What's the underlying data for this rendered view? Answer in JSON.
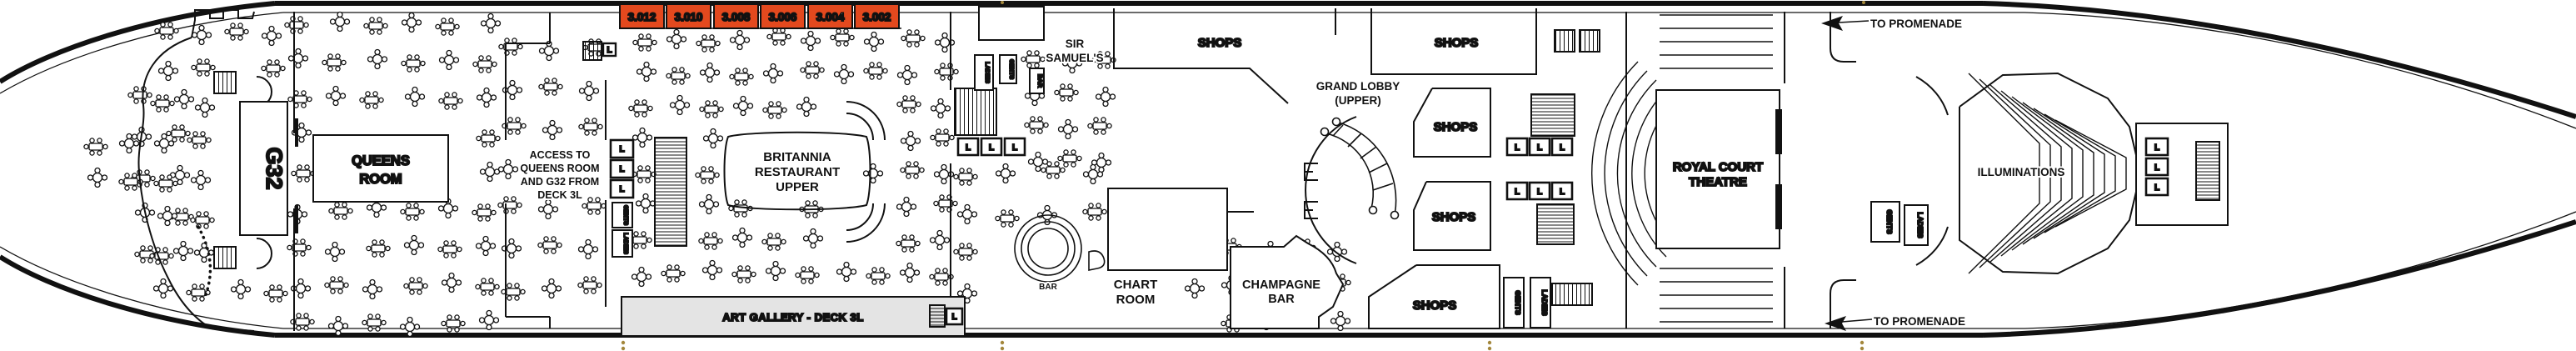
{
  "colors": {
    "cabin_fill": "#e3491e",
    "art_gallery_fill": "#e4e4e4",
    "gold_dot": "#a3873c",
    "line": "#111111"
  },
  "cabins": [
    "3.012",
    "3.010",
    "3.008",
    "3.006",
    "3.004",
    "3.002"
  ],
  "labels": {
    "g32": "G32",
    "queens_room": [
      "QUEENS",
      "ROOM"
    ],
    "access": [
      "ACCESS TO",
      "QUEENS ROOM",
      "AND G32 FROM",
      "DECK 3L"
    ],
    "britannia": [
      "BRITANNIA",
      "RESTAURANT",
      "UPPER"
    ],
    "art_gallery": "ART GALLERY - DECK 3L",
    "sir_samuels": [
      "SIR",
      "SAMUEL'S"
    ],
    "shops": "SHOPS",
    "grand_lobby": [
      "GRAND LOBBY",
      "(UPPER)"
    ],
    "chart_room": [
      "CHART",
      "ROOM"
    ],
    "champagne_bar": [
      "CHAMPAGNE",
      "BAR"
    ],
    "royal_court_theatre": [
      "ROYAL COURT",
      "THEATRE"
    ],
    "illuminations": "ILLUMINATIONS",
    "to_promenade": "TO PROMENADE",
    "bar": "BAR",
    "gents": "GENTS",
    "ladies": "LADIES",
    "lift": "L"
  }
}
